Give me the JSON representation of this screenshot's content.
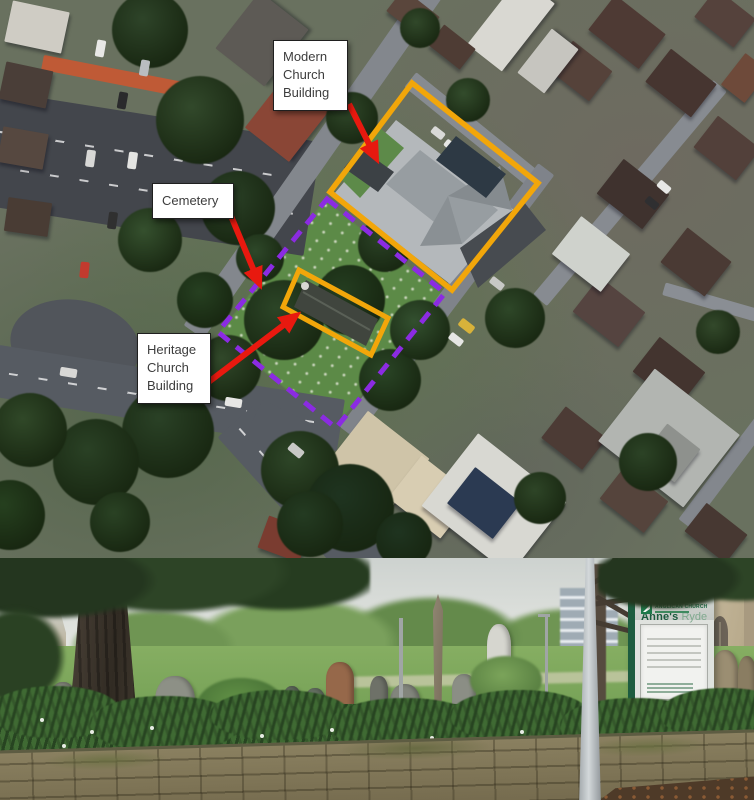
{
  "figure": {
    "aerial_map": {
      "annotations": [
        {
          "id": "modern-church",
          "label": "Modern Church Building"
        },
        {
          "id": "cemetery",
          "label": "Cemetery"
        },
        {
          "id": "heritage-church",
          "label": "Heritage Church Building"
        }
      ],
      "colors": {
        "building_outline_orange": "#F2A60A",
        "site_boundary_purple": "#8B2BE2",
        "arrow_red": "#E8190F"
      }
    },
    "photo": {
      "sign": {
        "title_primary": "St Anne's",
        "title_secondary": "Ryde",
        "org": "ANGLICAN CHURCH"
      }
    }
  }
}
